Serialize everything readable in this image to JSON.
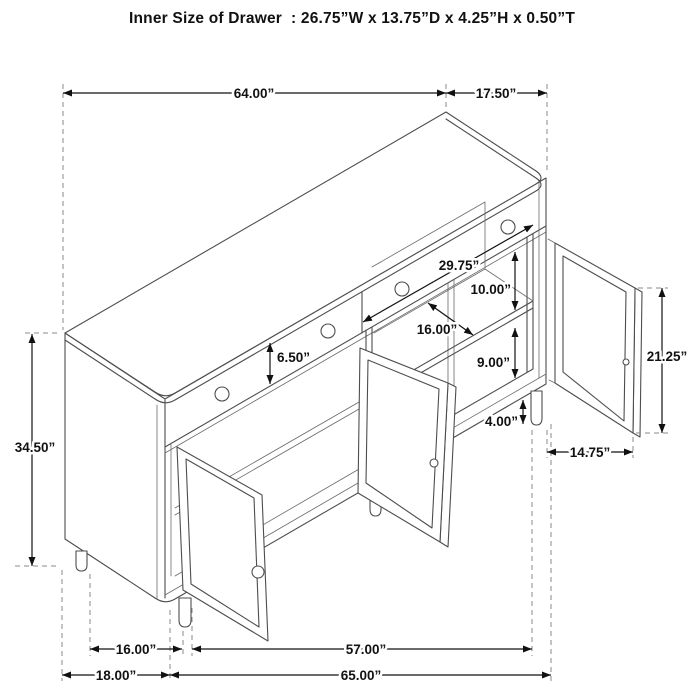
{
  "title": "Inner Size of Drawer  : 26.75”W x 13.75”D x 4.25”H x 0.50”T",
  "dimensions": {
    "top_width": "64.00”",
    "top_depth": "17.50”",
    "overall_height": "34.50”",
    "inner_section_width": "29.75”",
    "upper_shelf_clearance": "10.00”",
    "shelf_depth": "16.00”",
    "drawer_front_height": "6.50”",
    "lower_shelf_clearance": "9.00”",
    "leg_clearance": "4.00”",
    "door_opening_height": "21.25”",
    "door_width": "14.75”",
    "leg_span_side": "16.00”",
    "overall_depth": "18.00”",
    "leg_span_front": "57.00”",
    "overall_width": "65.00”"
  },
  "colors": {
    "background": "#ffffff",
    "drawing_line": "#4d4d4d",
    "dimension_line": "#111111",
    "extension_dashed": "#8a8a8a"
  }
}
